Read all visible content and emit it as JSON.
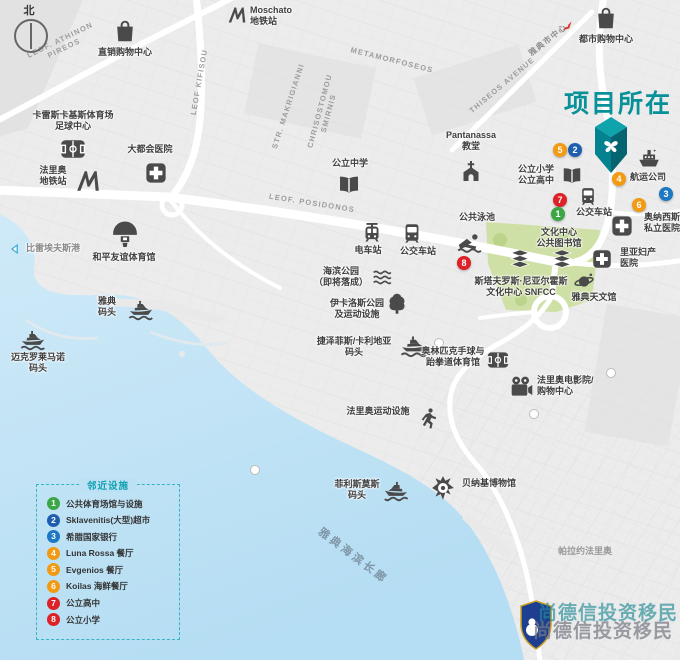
{
  "compass": {
    "north": "北"
  },
  "title": {
    "text": "项目所在",
    "color": "#089199"
  },
  "roads": {
    "athinon_l1": "LEOF. ATHINON",
    "athinon_l2": "PIREOS",
    "kifisou": "LEOF KIFISOU",
    "metamorfoseos": "METAMORFOSEOS",
    "makrigianni": "STR. MAKRIGIANNI",
    "smirnis_l1": "CHRISOSTOMOU",
    "smirnis_l2": "SMIRNIS",
    "thiseos": "THISEOS AVENUE",
    "posidonos": "LEOF. POSIDONOS",
    "to_city_center": "雅典市中心"
  },
  "areas": {
    "promenade": "雅典海滨长廊",
    "palaio_faliro": "帕拉约法里奥"
  },
  "pois": {
    "outlet_mall": {
      "label": "直销购物中心"
    },
    "moschato": {
      "l1": "Moschato",
      "l2": "地铁站"
    },
    "city_mall": {
      "label": "都市购物中心"
    },
    "karaiskakis": {
      "l1": "卡雷斯卡基斯体育场",
      "l2": "足球中心"
    },
    "metropolitan": {
      "label": "大都会医院"
    },
    "faliro_metro": {
      "l1": "法里奥",
      "l2": "地铁站"
    },
    "middle_school": {
      "label": "公立中学"
    },
    "pantanassa": {
      "l1": "Pantanassa",
      "l2": "教堂"
    },
    "project_schools": {
      "l1": "公立小学",
      "l2": "公立高中"
    },
    "public_pool": {
      "label": "公共泳池"
    },
    "tram_station": {
      "label": "电车站"
    },
    "bus_station_center": {
      "label": "公交车站"
    },
    "bus_station_project": {
      "label": "公交车站"
    },
    "culture_center": {
      "l1": "文化中心",
      "l2": "公共图书馆"
    },
    "snfcc": {
      "l1": "斯塔夫罗斯·尼亚尔霍斯",
      "l2": "文化中心 SNFCC"
    },
    "planetarium": {
      "label": "雅典天文馆"
    },
    "onassis_hospital": {
      "l1": "奥纳西斯",
      "l2": "私立医院"
    },
    "rea_hospital": {
      "l1": "里亚妇产",
      "l2": "医院"
    },
    "shipping_company": {
      "label": "航运公司"
    },
    "sef_stadium": {
      "label": "和平友谊体育馆"
    },
    "athens_marina": {
      "l1": "雅典",
      "l2": "码头"
    },
    "mikrolimano": {
      "l1": "迈克罗莱马诺",
      "l2": "码头"
    },
    "piraeus_port": {
      "label": "比雷埃夫斯港"
    },
    "seaside_park": {
      "l1": "海滨公园",
      "l2": "（即将落成）"
    },
    "ikaros_park": {
      "l1": "伊卡洛斯公园",
      "l2": "及运动设施"
    },
    "delta_marina": {
      "l1": "捷泽菲斯/卡利地亚",
      "l2": "码头"
    },
    "handball_arena": {
      "l1": "奥林匹克手球与",
      "l2": "跆拳道体育馆"
    },
    "cinema": {
      "l1": "法里奥电影院/",
      "l2": "购物中心"
    },
    "faliro_sports": {
      "label": "法里奥运动设施"
    },
    "flisvos_marina": {
      "l1": "菲利斯莫斯",
      "l2": "码头"
    },
    "benaki_museum": {
      "label": "贝纳基博物馆"
    }
  },
  "badges": {
    "map": [
      {
        "n": "5",
        "color": "#f29a11"
      },
      {
        "n": "2",
        "color": "#1d5fae"
      },
      {
        "n": "4",
        "color": "#f29a11"
      },
      {
        "n": "3",
        "color": "#1c78c2"
      },
      {
        "n": "7",
        "color": "#dd2127"
      },
      {
        "n": "1",
        "color": "#3aa646"
      },
      {
        "n": "6",
        "color": "#f29a11"
      },
      {
        "n": "8",
        "color": "#dd2127"
      }
    ]
  },
  "legend": {
    "title": "邻近设施",
    "items": [
      {
        "num": "1",
        "label": "公共体育场馆与设施",
        "color": "#3aa646"
      },
      {
        "num": "2",
        "label": "Sklavenitis(大型)超市",
        "color": "#1d5fae"
      },
      {
        "num": "3",
        "label": "希腊国家银行",
        "color": "#1c78c2"
      },
      {
        "num": "4",
        "label": "Luna Rossa 餐厅",
        "color": "#f29a11"
      },
      {
        "num": "5",
        "label": "Evgenios 餐厅",
        "color": "#f29a11"
      },
      {
        "num": "6",
        "label": "Koilas 海鲜餐厅",
        "color": "#f29a11"
      },
      {
        "num": "7",
        "label": "公立高中",
        "color": "#dd2127"
      },
      {
        "num": "8",
        "label": "公立小学",
        "color": "#dd2127"
      }
    ]
  },
  "watermark": {
    "text": "尚德信投资移民"
  },
  "palette": {
    "title_teal": "#089199",
    "marker_teal": "#05828f",
    "badge_green": "#3aa646",
    "badge_blue": "#1d5fae",
    "badge_lightblue": "#1c78c2",
    "badge_orange": "#f29a11",
    "badge_red": "#dd2127",
    "water": "#bfe3f6",
    "park_green": "#cfe0a6",
    "land_gray": "#ececec",
    "icon_gray": "#4a4a4a",
    "legend_border": "#35b4c4"
  }
}
